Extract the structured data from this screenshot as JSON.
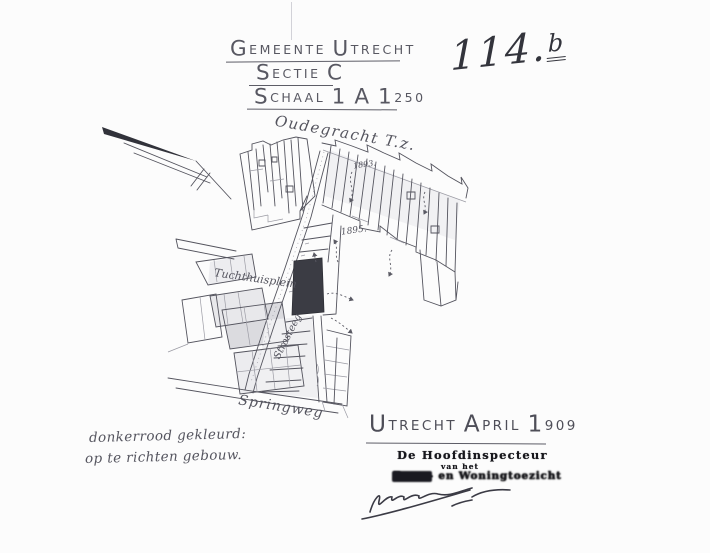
{
  "header": {
    "title_line1": "Gemeente Utrecht",
    "title_line2": "Sectie C",
    "title_line3": "Schaal 1 A 1250",
    "dossier_number_main": "114.",
    "dossier_number_sup": "b"
  },
  "map": {
    "labels": {
      "canal": "Oudegracht T.z.",
      "square": "Tuchthuisplein",
      "street_center": "Strosteeg",
      "street_bottom": "Springweg",
      "year_upper": "1893.",
      "year_lower": "1895."
    },
    "new_building_fill": "#3b3c44"
  },
  "note": {
    "line1": "donkerrood gekleurd:",
    "line2": "op te richten gebouw."
  },
  "approval": {
    "place_date": "Utrecht April 1909",
    "stamp_line1": "De Hoofdinspecteur",
    "stamp_line2": "van het",
    "stamp_line3": "Bouw- en Woningtoezicht"
  }
}
